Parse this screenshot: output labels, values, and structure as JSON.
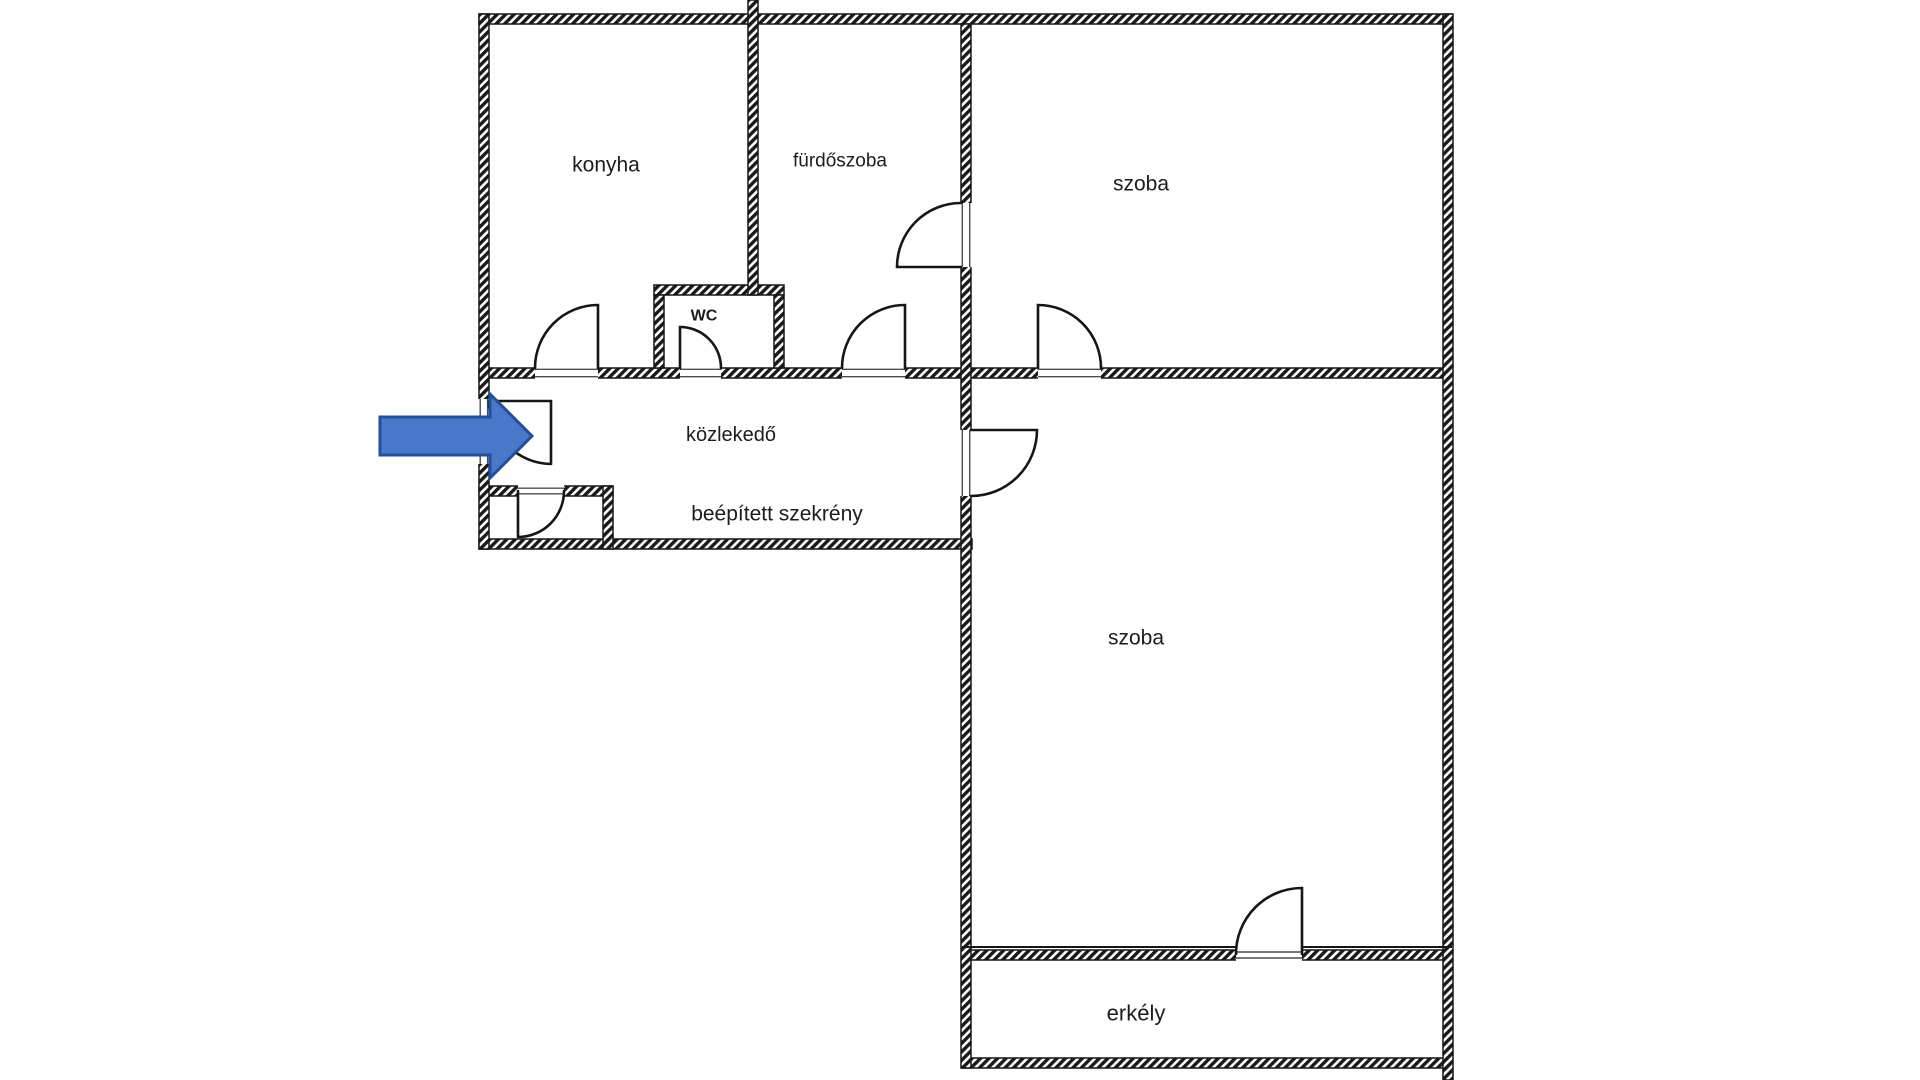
{
  "rooms": {
    "konyha": "konyha",
    "furdoszoba": "fürdőszoba",
    "szoba_felso": "szoba",
    "wc": "WC",
    "kozlekedo": "közlekedő",
    "beepitett_szekreny": "beépített szekrény",
    "szoba_also": "szoba",
    "erkely": "erkély"
  },
  "entrance_arrow": {
    "fill": "#4a78c8",
    "border": "#1f4f9e"
  },
  "palette": {
    "wall_ink": "#161616",
    "label_ink": "#1c1c1c",
    "threshold_line": "#4c4c4c",
    "background": "#ffffff"
  }
}
